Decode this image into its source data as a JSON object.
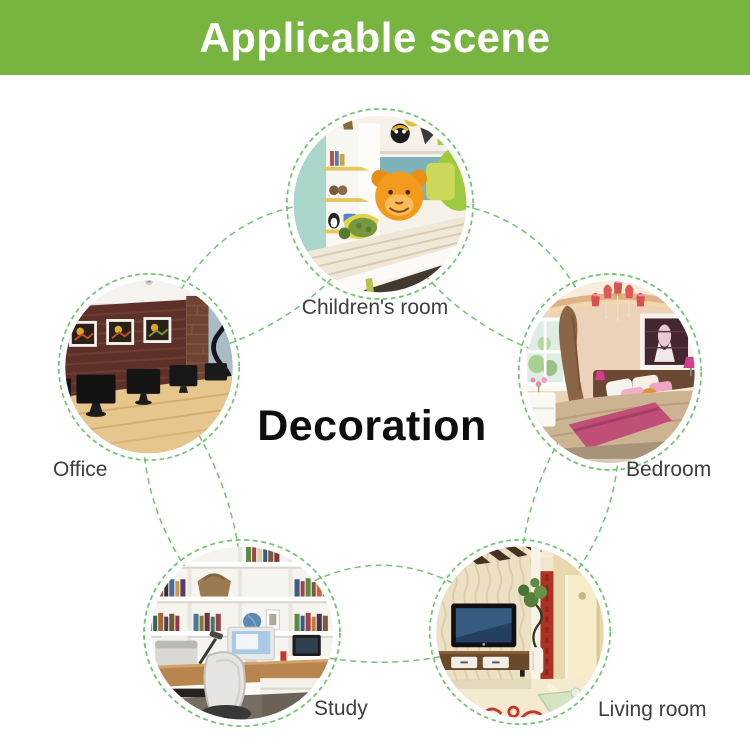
{
  "header": {
    "title": "Applicable scene"
  },
  "center": {
    "label": "Decoration"
  },
  "scenes": [
    {
      "id": "children-room",
      "label": "Children's room"
    },
    {
      "id": "office",
      "label": "Office"
    },
    {
      "id": "bedroom",
      "label": "Bedroom"
    },
    {
      "id": "study",
      "label": "Study"
    },
    {
      "id": "living-room",
      "label": "Living room"
    }
  ],
  "colors": {
    "banner_bg": "#78b440",
    "banner_text": "#ffffff",
    "connector_green": "#72c472",
    "label_text": "#3e3e3e",
    "center_text": "#0e0e0e"
  }
}
